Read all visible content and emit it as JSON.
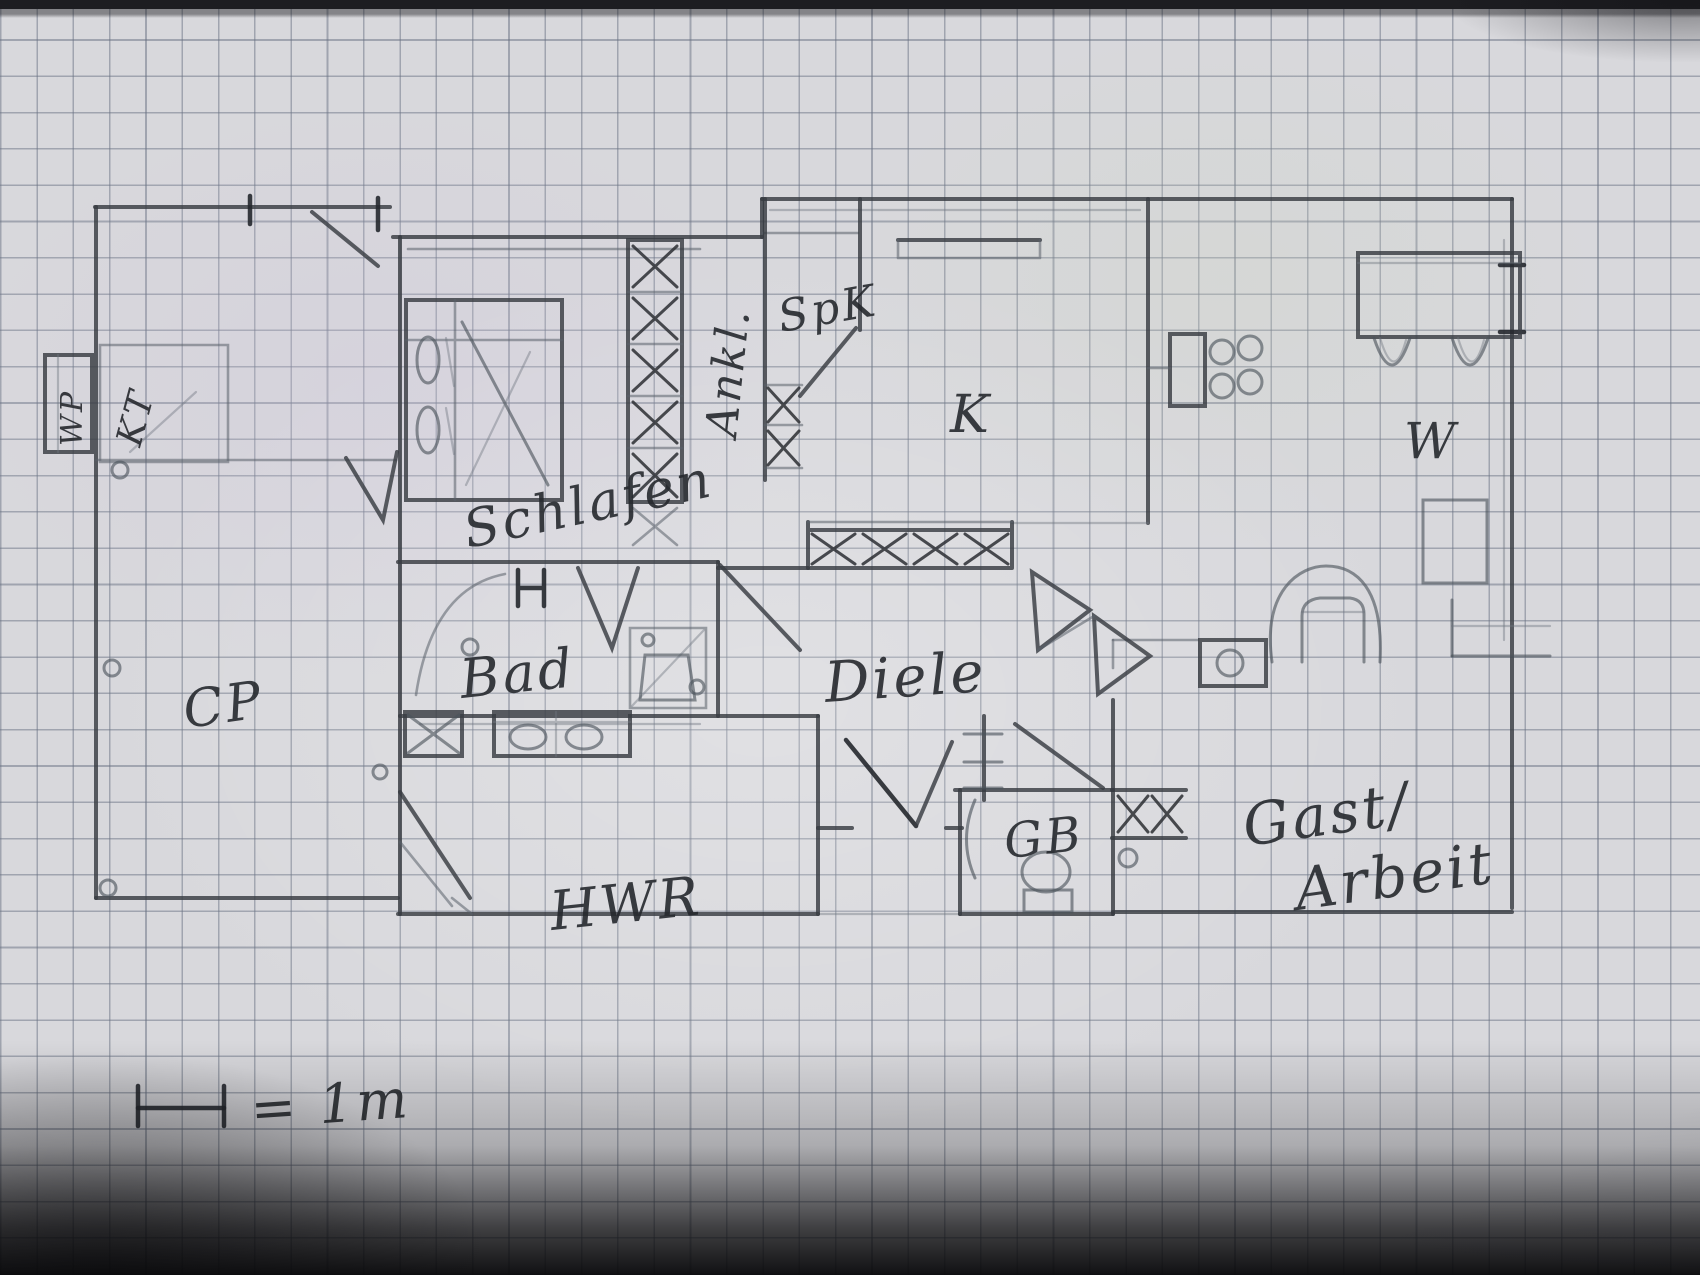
{
  "document": {
    "kind": "hand-drawn floor plan sketch in pencil on squared graph paper",
    "language": "German"
  },
  "labels": {
    "carport": "CP",
    "heat_pump": "WP",
    "kt_box": "KT",
    "bedroom": "Schlafen",
    "dressing": "Ankl.",
    "pantry": "SpK",
    "kitchen": "K",
    "bathroom": "Bad",
    "utility": "HWR",
    "hall": "Diele",
    "guest_wc": "GB",
    "living": "W",
    "guest_room_line1": "Gast/",
    "guest_room_line2": "Arbeit",
    "scale": "= 1m"
  },
  "colors": {
    "paper": "#d8d8dc",
    "grid_line": "#68717f",
    "pencil_wall": "#383c42",
    "pencil_dark": "#25282d",
    "ink_text": "#26292e"
  }
}
